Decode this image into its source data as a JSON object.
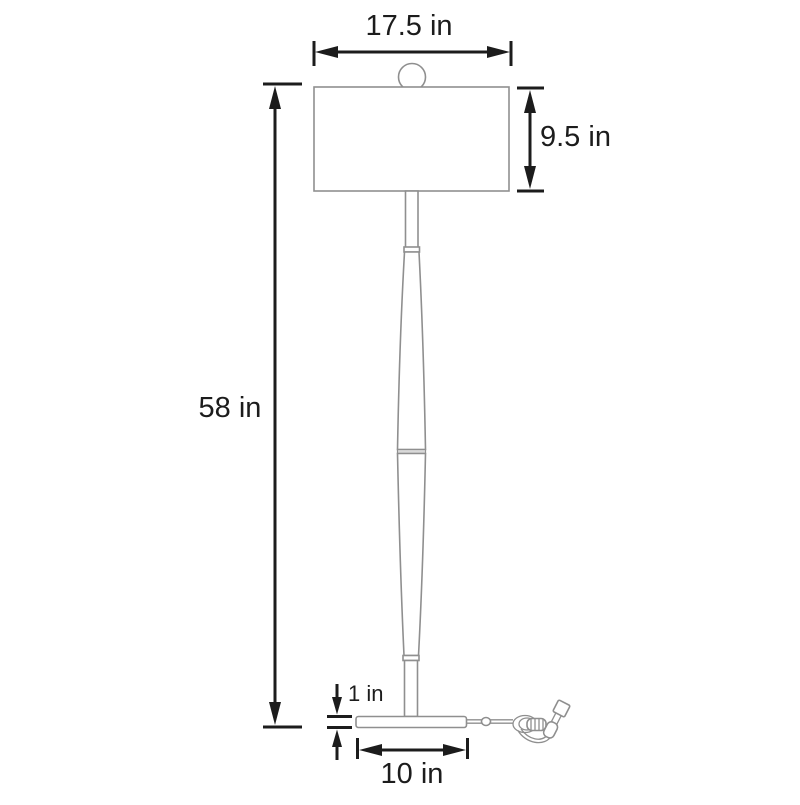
{
  "diagram": {
    "dimensions": {
      "shade_width": "17.5 in",
      "shade_height": "9.5 in",
      "total_height": "58 in",
      "base_thickness": "1 in",
      "base_width": "10 in"
    },
    "colors": {
      "dimension": "#1c1c1c",
      "outline": "#8f8f8f",
      "background": "#ffffff"
    }
  }
}
